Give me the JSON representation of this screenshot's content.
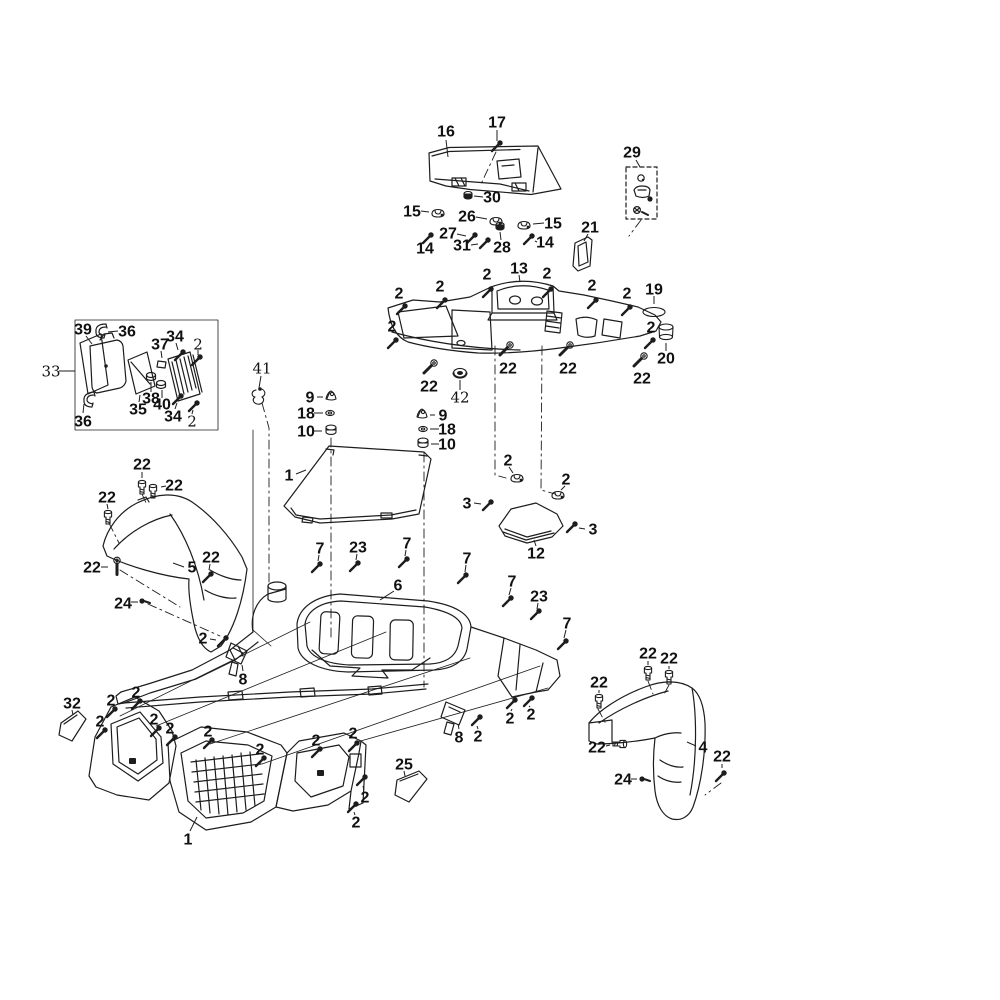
{
  "colors": {
    "ink": "#1d1d1d",
    "background": "#ffffff"
  },
  "callouts": [
    {
      "n": "16",
      "x": 446,
      "y": 131,
      "l": [
        446,
        140,
        448,
        157
      ]
    },
    {
      "n": "17",
      "x": 497,
      "y": 122,
      "l": [
        497,
        130,
        497,
        141
      ],
      "p": {
        "t": "screw",
        "x": 497,
        "y": 146
      }
    },
    {
      "n": "29",
      "x": 632,
      "y": 152,
      "l": [
        636,
        160,
        640,
        167
      ]
    },
    {
      "n": "30",
      "x": 492,
      "y": 197,
      "l": [
        483,
        197,
        474,
        196
      ],
      "p": {
        "t": "grommet",
        "x": 468,
        "y": 195
      }
    },
    {
      "n": "15",
      "x": 412,
      "y": 211,
      "l": [
        421,
        211,
        429,
        212
      ],
      "p": {
        "t": "clip",
        "x": 438,
        "y": 213
      }
    },
    {
      "n": "26",
      "x": 467,
      "y": 216,
      "l": [
        476,
        217,
        487,
        219
      ],
      "p": {
        "t": "clip",
        "x": 496,
        "y": 221
      }
    },
    {
      "n": "15",
      "x": 553,
      "y": 223,
      "l": [
        544,
        223,
        533,
        224
      ],
      "p": {
        "t": "clip",
        "x": 524,
        "y": 225
      }
    },
    {
      "n": "21",
      "x": 590,
      "y": 227,
      "l": [
        588,
        234,
        584,
        241
      ]
    },
    {
      "n": "27",
      "x": 448,
      "y": 233,
      "l": [
        457,
        234,
        466,
        236
      ],
      "p": {
        "t": "screw",
        "x": 472,
        "y": 238
      }
    },
    {
      "n": "31",
      "x": 462,
      "y": 245,
      "l": [
        471,
        245,
        478,
        244
      ],
      "p": {
        "t": "screw",
        "x": 485,
        "y": 243
      }
    },
    {
      "n": "28",
      "x": 502,
      "y": 247,
      "l": [
        501,
        240,
        500,
        232
      ],
      "p": {
        "t": "grommet",
        "x": 500,
        "y": 226
      }
    },
    {
      "n": "14",
      "x": 425,
      "y": 248,
      "p": {
        "t": "screw",
        "x": 428,
        "y": 238
      }
    },
    {
      "n": "14",
      "x": 545,
      "y": 242,
      "l": [
        537,
        242,
        535,
        241
      ],
      "p": {
        "t": "screw",
        "x": 529,
        "y": 239
      }
    },
    {
      "n": "13",
      "x": 519,
      "y": 268,
      "l": [
        519,
        275,
        520,
        282
      ]
    },
    {
      "n": "2",
      "x": 399,
      "y": 293,
      "p": {
        "t": "screw",
        "x": 402,
        "y": 309
      }
    },
    {
      "n": "2",
      "x": 440,
      "y": 286,
      "p": {
        "t": "screw",
        "x": 442,
        "y": 303
      }
    },
    {
      "n": "2",
      "x": 487,
      "y": 274,
      "p": {
        "t": "screw",
        "x": 488,
        "y": 292
      }
    },
    {
      "n": "2",
      "x": 547,
      "y": 273,
      "p": {
        "t": "screw",
        "x": 548,
        "y": 292
      }
    },
    {
      "n": "2",
      "x": 592,
      "y": 285,
      "p": {
        "t": "screw",
        "x": 593,
        "y": 303
      }
    },
    {
      "n": "2",
      "x": 627,
      "y": 293,
      "p": {
        "t": "screw",
        "x": 627,
        "y": 310
      }
    },
    {
      "n": "19",
      "x": 654,
      "y": 289,
      "l": [
        654,
        296,
        654,
        304
      ],
      "p": {
        "t": "oval",
        "x": 654,
        "y": 312
      }
    },
    {
      "n": "2",
      "x": 392,
      "y": 326,
      "p": {
        "t": "screw",
        "x": 393,
        "y": 343
      }
    },
    {
      "n": "2",
      "x": 651,
      "y": 327,
      "p": {
        "t": "screw",
        "x": 650,
        "y": 343
      }
    },
    {
      "n": "20",
      "x": 666,
      "y": 358,
      "l": [
        666,
        351,
        666,
        343
      ],
      "p": {
        "t": "cup",
        "x": 666,
        "y": 331
      }
    },
    {
      "n": "22",
      "x": 429,
      "y": 386,
      "p": {
        "t": "bolt45",
        "x": 430,
        "y": 367
      }
    },
    {
      "n": "42",
      "x": 460,
      "y": 397,
      "light": true,
      "l": [
        460,
        390,
        460,
        380
      ],
      "p": {
        "t": "washer42",
        "x": 460,
        "y": 373
      }
    },
    {
      "n": "22",
      "x": 508,
      "y": 368,
      "p": {
        "t": "bolt45",
        "x": 506,
        "y": 349
      }
    },
    {
      "n": "22",
      "x": 568,
      "y": 368,
      "p": {
        "t": "bolt45",
        "x": 566,
        "y": 349
      }
    },
    {
      "n": "22",
      "x": 642,
      "y": 378,
      "p": {
        "t": "bolt45",
        "x": 640,
        "y": 360
      }
    },
    {
      "n": "39",
      "x": 83,
      "y": 329,
      "l": [
        86,
        336,
        92,
        344
      ]
    },
    {
      "n": "36",
      "x": 127,
      "y": 331,
      "l": [
        118,
        331,
        108,
        332
      ]
    },
    {
      "n": "37",
      "x": 160,
      "y": 344,
      "l": [
        161,
        351,
        162,
        358
      ]
    },
    {
      "n": "34",
      "x": 175,
      "y": 336,
      "l": [
        176,
        343,
        178,
        350
      ],
      "p": {
        "t": "screw",
        "x": 180,
        "y": 355
      }
    },
    {
      "n": "2",
      "x": 198,
      "y": 344,
      "light": true,
      "l": [
        198,
        350,
        198,
        355
      ],
      "p": {
        "t": "screw",
        "x": 197,
        "y": 360
      }
    },
    {
      "n": "33",
      "x": 51,
      "y": 371,
      "light": true,
      "l": [
        59,
        371,
        75,
        371
      ]
    },
    {
      "n": "35",
      "x": 138,
      "y": 409,
      "l": [
        139,
        402,
        140,
        395
      ]
    },
    {
      "n": "38",
      "x": 151,
      "y": 398,
      "l": [
        151,
        392,
        151,
        382
      ]
    },
    {
      "n": "40",
      "x": 162,
      "y": 404,
      "l": [
        162,
        398,
        162,
        390
      ]
    },
    {
      "n": "34",
      "x": 173,
      "y": 416,
      "l": [
        175,
        409,
        177,
        403
      ],
      "p": {
        "t": "screw",
        "x": 178,
        "y": 399
      }
    },
    {
      "n": "2",
      "x": 192,
      "y": 421,
      "light": true,
      "l": [
        192,
        414,
        193,
        410
      ],
      "p": {
        "t": "screw",
        "x": 194,
        "y": 406
      }
    },
    {
      "n": "36",
      "x": 83,
      "y": 421,
      "l": [
        83,
        413,
        84,
        404
      ]
    },
    {
      "n": "41",
      "x": 262,
      "y": 368,
      "light": true,
      "l": [
        261,
        376,
        259,
        388
      ],
      "p": {
        "t": "hook",
        "x": 258,
        "y": 396
      }
    },
    {
      "n": "9",
      "x": 310,
      "y": 397,
      "l": [
        317,
        397,
        323,
        397
      ],
      "p": {
        "t": "clip9",
        "x": 331,
        "y": 396
      }
    },
    {
      "n": "18",
      "x": 306,
      "y": 413,
      "l": [
        314,
        413,
        323,
        413
      ],
      "p": {
        "t": "washer",
        "x": 330,
        "y": 413
      }
    },
    {
      "n": "10",
      "x": 306,
      "y": 431,
      "l": [
        314,
        431,
        322,
        431
      ],
      "p": {
        "t": "grommet10",
        "x": 331,
        "y": 430
      }
    },
    {
      "n": "9",
      "x": 443,
      "y": 415,
      "l": [
        435,
        415,
        430,
        415
      ],
      "p": {
        "t": "clip9",
        "x": 422,
        "y": 414
      }
    },
    {
      "n": "18",
      "x": 447,
      "y": 429,
      "l": [
        439,
        429,
        430,
        429
      ],
      "p": {
        "t": "washer",
        "x": 423,
        "y": 429
      }
    },
    {
      "n": "10",
      "x": 447,
      "y": 444,
      "l": [
        439,
        444,
        431,
        444
      ],
      "p": {
        "t": "grommet10",
        "x": 423,
        "y": 443
      }
    },
    {
      "n": "1",
      "x": 289,
      "y": 475,
      "l": [
        296,
        474,
        306,
        470
      ]
    },
    {
      "n": "2",
      "x": 508,
      "y": 460,
      "l": [
        509,
        467,
        513,
        473
      ],
      "p": {
        "t": "clip",
        "x": 517,
        "y": 478
      }
    },
    {
      "n": "2",
      "x": 566,
      "y": 479,
      "l": [
        565,
        486,
        561,
        490
      ],
      "p": {
        "t": "clip",
        "x": 558,
        "y": 495
      }
    },
    {
      "n": "3",
      "x": 467,
      "y": 503,
      "l": [
        474,
        503,
        481,
        504
      ],
      "p": {
        "t": "screw",
        "x": 488,
        "y": 505
      }
    },
    {
      "n": "3",
      "x": 593,
      "y": 529,
      "l": [
        585,
        529,
        579,
        528
      ],
      "p": {
        "t": "screw",
        "x": 572,
        "y": 527
      }
    },
    {
      "n": "12",
      "x": 536,
      "y": 553,
      "l": [
        536,
        546,
        534,
        540
      ]
    },
    {
      "n": "22",
      "x": 142,
      "y": 464,
      "l": [
        142,
        472,
        142,
        478
      ],
      "p": {
        "t": "boltv",
        "x": 142,
        "y": 488
      }
    },
    {
      "n": "22",
      "x": 174,
      "y": 485,
      "l": [
        166,
        486,
        161,
        487
      ],
      "p": {
        "t": "boltv",
        "x": 153,
        "y": 492
      }
    },
    {
      "n": "22",
      "x": 107,
      "y": 497,
      "l": [
        107,
        504,
        108,
        509
      ],
      "p": {
        "t": "boltv",
        "x": 108,
        "y": 518
      }
    },
    {
      "n": "22",
      "x": 92,
      "y": 567,
      "l": [
        101,
        567,
        108,
        567
      ],
      "p": {
        "t": "bolt45",
        "x": 117,
        "y": 566,
        "r": -45
      }
    },
    {
      "n": "5",
      "x": 192,
      "y": 567,
      "l": [
        184,
        567,
        173,
        563
      ]
    },
    {
      "n": "22",
      "x": 211,
      "y": 557,
      "l": [
        210,
        564,
        209,
        570
      ],
      "p": {
        "t": "screw",
        "x": 208,
        "y": 577
      }
    },
    {
      "n": "24",
      "x": 123,
      "y": 603,
      "l": [
        131,
        602,
        138,
        602
      ],
      "p": {
        "t": "rivet",
        "x": 144,
        "y": 601
      }
    },
    {
      "n": "2",
      "x": 203,
      "y": 638,
      "l": [
        210,
        639,
        216,
        640
      ],
      "p": {
        "t": "screw",
        "x": 223,
        "y": 641
      }
    },
    {
      "n": "7",
      "x": 320,
      "y": 548,
      "l": [
        319,
        555,
        318,
        561
      ],
      "p": {
        "t": "screw",
        "x": 317,
        "y": 567
      }
    },
    {
      "n": "23",
      "x": 358,
      "y": 547,
      "l": [
        357,
        554,
        356,
        560
      ],
      "p": {
        "t": "screw",
        "x": 355,
        "y": 566
      }
    },
    {
      "n": "7",
      "x": 407,
      "y": 543,
      "l": [
        406,
        550,
        405,
        556
      ],
      "p": {
        "t": "screw",
        "x": 404,
        "y": 562
      }
    },
    {
      "n": "7",
      "x": 467,
      "y": 558,
      "l": [
        466,
        565,
        465,
        572
      ],
      "p": {
        "t": "screw",
        "x": 463,
        "y": 578
      }
    },
    {
      "n": "6",
      "x": 398,
      "y": 585,
      "l": [
        394,
        591,
        380,
        600
      ]
    },
    {
      "n": "7",
      "x": 512,
      "y": 581,
      "l": [
        511,
        588,
        509,
        595
      ],
      "p": {
        "t": "screw",
        "x": 508,
        "y": 601
      }
    },
    {
      "n": "23",
      "x": 539,
      "y": 596,
      "l": [
        538,
        603,
        537,
        609
      ],
      "p": {
        "t": "screw",
        "x": 536,
        "y": 614
      }
    },
    {
      "n": "7",
      "x": 567,
      "y": 623,
      "l": [
        566,
        630,
        564,
        638
      ],
      "p": {
        "t": "screw",
        "x": 563,
        "y": 644
      }
    },
    {
      "n": "8",
      "x": 243,
      "y": 679,
      "l": [
        243,
        671,
        242,
        665
      ]
    },
    {
      "n": "8",
      "x": 459,
      "y": 737,
      "l": [
        459,
        729,
        458,
        724
      ]
    },
    {
      "n": "2",
      "x": 478,
      "y": 736,
      "l": [
        478,
        729,
        477,
        726
      ],
      "p": {
        "t": "screw",
        "x": 477,
        "y": 720
      }
    },
    {
      "n": "2",
      "x": 510,
      "y": 718,
      "l": [
        511,
        711,
        512,
        709
      ],
      "p": {
        "t": "screw",
        "x": 512,
        "y": 703
      }
    },
    {
      "n": "2",
      "x": 531,
      "y": 714,
      "l": [
        530,
        707,
        529,
        706
      ],
      "p": {
        "t": "screw",
        "x": 529,
        "y": 701
      }
    },
    {
      "n": "32",
      "x": 72,
      "y": 703,
      "l": [
        72,
        710,
        73,
        715
      ]
    },
    {
      "n": "2",
      "x": 111,
      "y": 700,
      "p": {
        "t": "screw",
        "x": 112,
        "y": 712
      }
    },
    {
      "n": "2",
      "x": 136,
      "y": 692,
      "p": {
        "t": "screw",
        "x": 137,
        "y": 704
      }
    },
    {
      "n": "2",
      "x": 100,
      "y": 721,
      "p": {
        "t": "screw",
        "x": 102,
        "y": 733
      }
    },
    {
      "n": "2",
      "x": 154,
      "y": 719,
      "p": {
        "t": "screw",
        "x": 156,
        "y": 731
      }
    },
    {
      "n": "2",
      "x": 170,
      "y": 728,
      "p": {
        "t": "screw",
        "x": 172,
        "y": 740
      }
    },
    {
      "n": "2",
      "x": 208,
      "y": 731,
      "p": {
        "t": "screw",
        "x": 209,
        "y": 743
      }
    },
    {
      "n": "2",
      "x": 260,
      "y": 749,
      "p": {
        "t": "screw",
        "x": 261,
        "y": 761
      }
    },
    {
      "n": "2",
      "x": 316,
      "y": 740,
      "p": {
        "t": "screw",
        "x": 317,
        "y": 752
      }
    },
    {
      "n": "2",
      "x": 353,
      "y": 733,
      "p": {
        "t": "screw",
        "x": 354,
        "y": 746
      }
    },
    {
      "n": "1",
      "x": 188,
      "y": 839,
      "l": [
        190,
        831,
        197,
        817
      ]
    },
    {
      "n": "25",
      "x": 404,
      "y": 764,
      "l": [
        404,
        771,
        405,
        776
      ]
    },
    {
      "n": "2",
      "x": 365,
      "y": 797,
      "l": [
        364,
        790,
        363,
        786
      ],
      "p": {
        "t": "screw",
        "x": 362,
        "y": 780
      }
    },
    {
      "n": "2",
      "x": 356,
      "y": 822,
      "l": [
        355,
        815,
        354,
        812
      ],
      "p": {
        "t": "screw",
        "x": 353,
        "y": 807
      }
    },
    {
      "n": "22",
      "x": 648,
      "y": 653,
      "l": [
        648,
        661,
        648,
        665
      ],
      "p": {
        "t": "boltv",
        "x": 648,
        "y": 674
      }
    },
    {
      "n": "22",
      "x": 669,
      "y": 658,
      "l": [
        669,
        666,
        669,
        669
      ],
      "p": {
        "t": "boltv",
        "x": 669,
        "y": 678
      }
    },
    {
      "n": "22",
      "x": 599,
      "y": 682,
      "l": [
        599,
        690,
        599,
        693
      ],
      "p": {
        "t": "boltv",
        "x": 599,
        "y": 702
      }
    },
    {
      "n": "22",
      "x": 597,
      "y": 747,
      "l": [
        606,
        746,
        610,
        745
      ],
      "p": {
        "t": "boltv",
        "x": 619,
        "y": 744,
        "r": 90
      }
    },
    {
      "n": "4",
      "x": 703,
      "y": 747,
      "l": [
        696,
        746,
        687,
        742
      ]
    },
    {
      "n": "22",
      "x": 722,
      "y": 756,
      "l": [
        722,
        764,
        722,
        768
      ],
      "p": {
        "t": "screw",
        "x": 721,
        "y": 776
      }
    },
    {
      "n": "24",
      "x": 623,
      "y": 779,
      "l": [
        631,
        779,
        637,
        779
      ],
      "p": {
        "t": "rivet",
        "x": 644,
        "y": 779
      }
    }
  ]
}
